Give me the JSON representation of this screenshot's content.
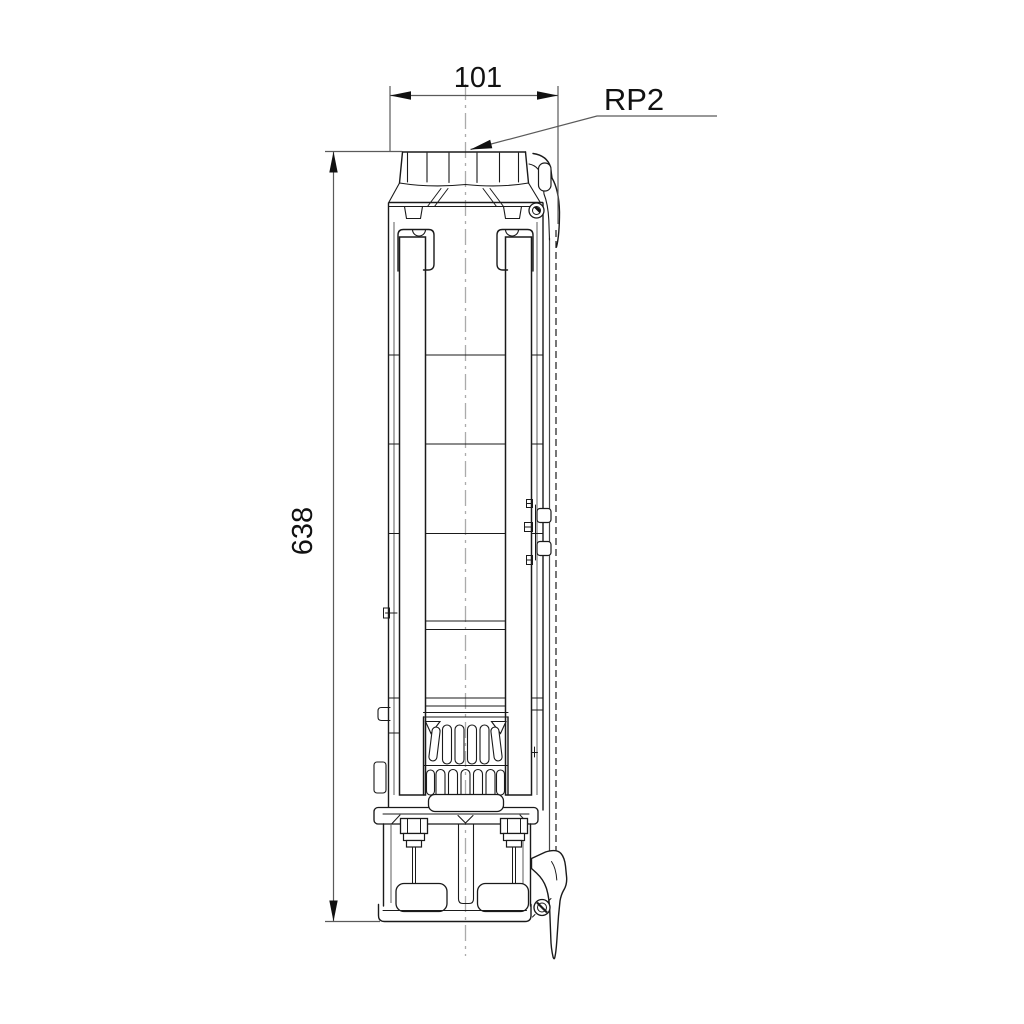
{
  "drawing": {
    "title": "submersible pump dimensional drawing",
    "type": "technical-dimension-drawing",
    "background_color": "#ffffff",
    "outline_color": "#1a1a1a",
    "dimension_line_color": "#5a5a5a",
    "centerline_color": "#ababab",
    "dimensions": {
      "width": {
        "label": "101",
        "orientation": "horizontal",
        "position": "top"
      },
      "height": {
        "label": "638",
        "orientation": "vertical",
        "position": "left"
      },
      "thread_callout": {
        "label": "RP2",
        "position": "top-right",
        "points_to": "discharge-thread"
      }
    }
  }
}
